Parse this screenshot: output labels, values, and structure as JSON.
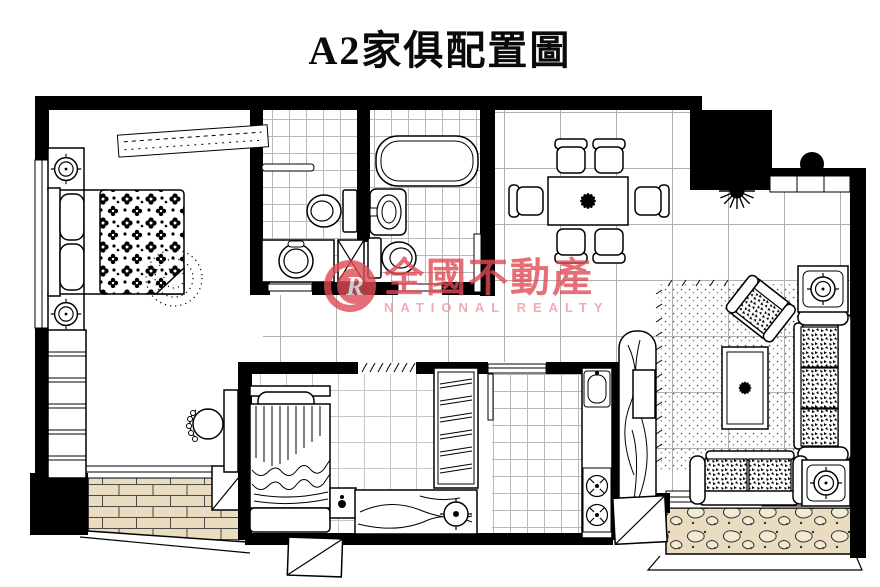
{
  "title": "A2家俱配置圖",
  "watermark": {
    "logo_letter": "R",
    "brand": "全國不動產",
    "brand_en": "NATIONAL REALTY",
    "brand_color": "#e04a55"
  },
  "palette": {
    "walls": "#000000",
    "lines": "#000000",
    "floor_tile_line": "#b5b5b5",
    "brick_balcony": "#e9dcc0",
    "pebble_balcony": "#e9dcc0",
    "watermark_red": "#e04a55",
    "watermark_pink": "#ef98a0",
    "background": "#ffffff"
  },
  "plan": {
    "unit": "A2",
    "kind": "furniture placement floor plan",
    "rooms": [
      "master-bedroom",
      "bathroom-1",
      "bathroom-2",
      "dining-room",
      "living-room",
      "bedroom-2",
      "kitchen",
      "hallway",
      "balcony-left",
      "balcony-right"
    ],
    "furniture_icons": [
      "double-bed-icon",
      "nightstand-lamp-icon",
      "overhead-cabinet-icon",
      "wardrobe-icon",
      "vanity-chair-icon",
      "toilet-icon",
      "bathtub-icon",
      "washbasin-icon",
      "pipe-shaft-icon",
      "dining-table-icon",
      "dining-chair-icon",
      "potted-plant-icon",
      "round-planter-icon",
      "console-cabinet-icon",
      "armchair-icon",
      "three-seat-sofa-icon",
      "loveseat-icon",
      "side-table-lamp-icon",
      "coffee-table-icon",
      "area-rug-icon",
      "tv-cabinet-icon",
      "single-bed-icon",
      "desk-icon",
      "stool-icon",
      "kitchen-sink-icon",
      "stove-icon",
      "sliding-door-icon",
      "ac-unit-icon",
      "window-icon"
    ]
  }
}
